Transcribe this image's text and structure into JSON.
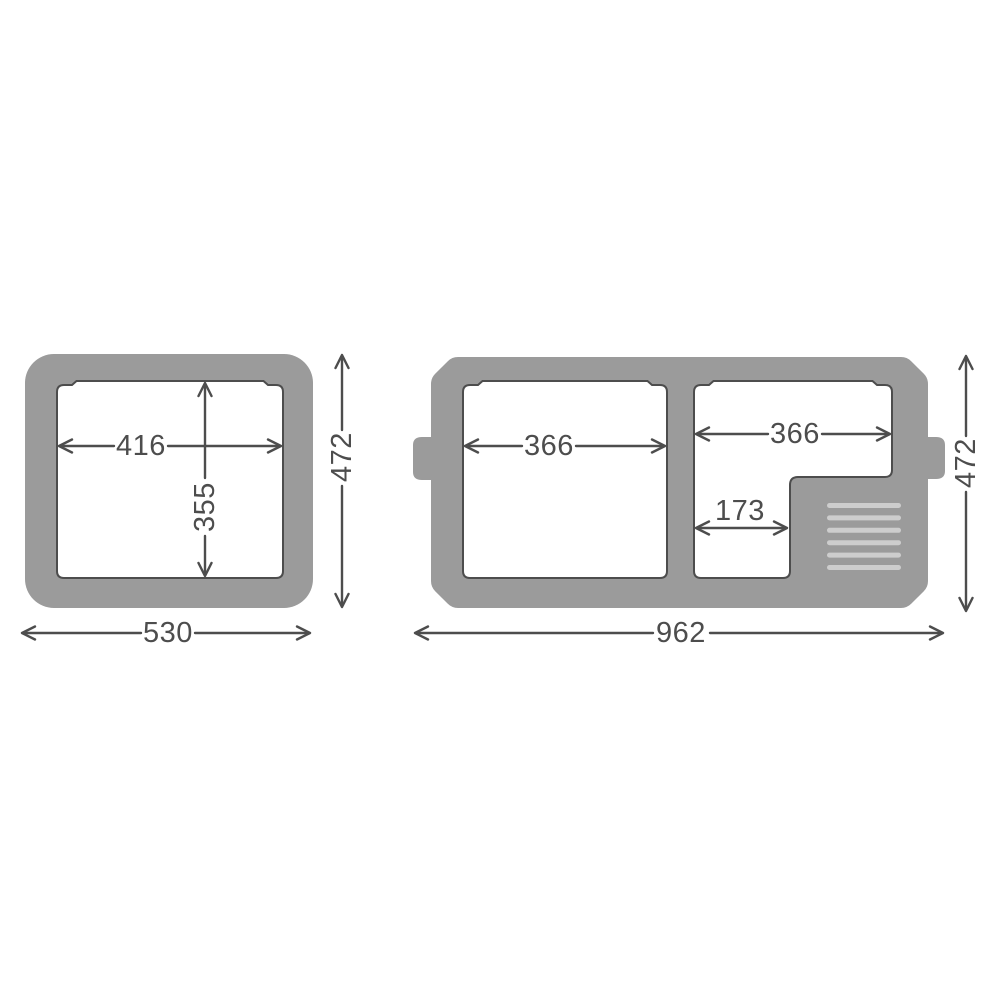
{
  "diagram": {
    "colors": {
      "body_gray": "#9b9b9b",
      "grille_bar": "#cdcdcd",
      "dimension_line": "#4d4d4d",
      "background": "#ffffff"
    },
    "small_unit": {
      "inner_width": "416",
      "inner_depth": "355",
      "overall_depth": "472",
      "overall_width": "530"
    },
    "large_unit": {
      "left_compartment_width": "366",
      "right_compartment_width": "366",
      "compressor_step_width": "173",
      "overall_depth": "472",
      "overall_width": "962"
    }
  }
}
